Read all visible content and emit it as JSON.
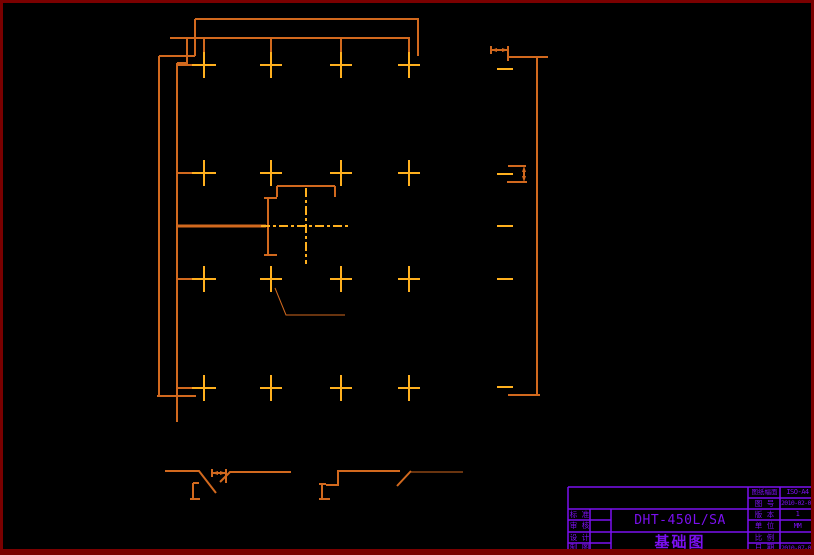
{
  "drawing": {
    "sheet_title": "基础图",
    "model_number": "DHT-450L/SA",
    "type": "foundation-plan-cad-drawing"
  },
  "title_block": {
    "left_rows": [
      {
        "label": "标 准",
        "value": ""
      },
      {
        "label": "审 核",
        "value": ""
      },
      {
        "label": "设 计",
        "value": ""
      },
      {
        "label": "制 图",
        "value": ""
      }
    ],
    "center": {
      "model": "DHT-450L/SA",
      "drawing_title": "基础图"
    },
    "right_rows": [
      {
        "label": "图纸幅面",
        "value": "ISO-A4"
      },
      {
        "label": "图 号",
        "value": "2010-02-01"
      },
      {
        "label": "版 本",
        "value": "1"
      },
      {
        "label": "单 位",
        "value": "MM"
      },
      {
        "label": "比 例",
        "value": ""
      },
      {
        "label": "日 期",
        "value": "2010-07-01"
      }
    ]
  },
  "colors": {
    "background": "#000000",
    "sheet_border_dark_red": "#7a0000",
    "plan_line_orange": "#d2691e",
    "centerline_yellow": "#ffb01e",
    "title_block_purple": "#7b10f0"
  },
  "plan": {
    "anchor_cross_columns": 4,
    "anchor_cross_rows": 4,
    "section_details": 2
  }
}
